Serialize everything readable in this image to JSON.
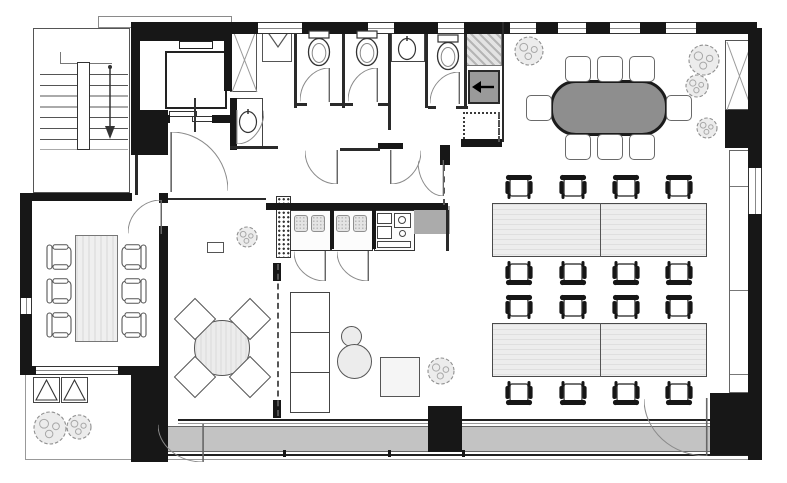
{
  "meta": {
    "drawing_type": "architectural floor plan, black-and-white office fit-out",
    "text_on_image": "none"
  },
  "colors": {
    "wall": "#171717",
    "meeting_table_gray": "#8e8e8e",
    "desk_fill": "#ededed",
    "balcony_gray": "#c3c3c3",
    "service_gray": "#9a9a9a",
    "tree_fill": "#ececec",
    "paper": "#ffffff"
  },
  "inventory": {
    "stairwell": 1,
    "elevator": 1,
    "toilet_stalls": 3,
    "wash_basins": 2,
    "service_shafts_x": 2,
    "dumbwaiter": 1,
    "phone_booths": 2,
    "kitchenette": 1,
    "small_meeting_room_seats": 6,
    "large_meeting_table_seats": 8,
    "desk_banks": 2,
    "desks": 4,
    "task_chairs": 16,
    "lounge_round_table_seats": 4,
    "sofa_sections": 3,
    "poufs": 2,
    "side_tables": 1,
    "trees": 8,
    "planters": 2,
    "balcony_strip": 1,
    "terrace": 1
  },
  "geometry": {
    "walls": [
      [
        131,
        22,
        626,
        12
      ],
      [
        131,
        33,
        101,
        8
      ],
      [
        131,
        33,
        9,
        92
      ],
      [
        224,
        33,
        8,
        58
      ],
      [
        140,
        115,
        30,
        8
      ],
      [
        212,
        115,
        20,
        8
      ],
      [
        131,
        110,
        37,
        45
      ],
      [
        230,
        98,
        7,
        52
      ],
      [
        378,
        143,
        25,
        6
      ],
      [
        440,
        145,
        10,
        20
      ],
      [
        461,
        139,
        41,
        8
      ],
      [
        266,
        203,
        182,
        7
      ],
      [
        330,
        210,
        4,
        39
      ],
      [
        372,
        210,
        4,
        39
      ],
      [
        273,
        263,
        8,
        18
      ],
      [
        273,
        400,
        8,
        18
      ],
      [
        20,
        193,
        112,
        8
      ],
      [
        159,
        193,
        9,
        10
      ],
      [
        20,
        193,
        12,
        180
      ],
      [
        20,
        366,
        148,
        9
      ],
      [
        159,
        226,
        9,
        147
      ],
      [
        131,
        370,
        37,
        92
      ],
      [
        428,
        406,
        34,
        46
      ],
      [
        710,
        393,
        47,
        62
      ],
      [
        748,
        28,
        14,
        432
      ],
      [
        725,
        110,
        28,
        38
      ]
    ],
    "thin_walls": [
      [
        294,
        34,
        3,
        74
      ],
      [
        342,
        34,
        3,
        74
      ],
      [
        388,
        34,
        3,
        96
      ],
      [
        425,
        34,
        3,
        74
      ],
      [
        464,
        34,
        3,
        74
      ],
      [
        297,
        103,
        10,
        3
      ],
      [
        330,
        103,
        15,
        3
      ],
      [
        345,
        103,
        8,
        3
      ],
      [
        378,
        103,
        13,
        3
      ],
      [
        428,
        106,
        8,
        3
      ],
      [
        456,
        106,
        12,
        3
      ],
      [
        230,
        146,
        48,
        3
      ],
      [
        340,
        148,
        40,
        3
      ],
      [
        135,
        155,
        3,
        40
      ],
      [
        168,
        198,
        98,
        2
      ],
      [
        502,
        22,
        2,
        120
      ],
      [
        446,
        210,
        3,
        41
      ]
    ],
    "windows_h": [
      [
        258,
        22,
        44,
        12
      ],
      [
        368,
        22,
        26,
        12
      ],
      [
        438,
        22,
        26,
        12
      ],
      [
        510,
        22,
        26,
        12
      ],
      [
        558,
        22,
        28,
        12
      ],
      [
        610,
        22,
        30,
        12
      ],
      [
        666,
        22,
        30,
        12
      ],
      [
        36,
        366,
        82,
        9
      ]
    ],
    "windows_v": [
      [
        748,
        168,
        14,
        46
      ],
      [
        20,
        298,
        12,
        16
      ]
    ],
    "doors": [
      [
        128,
        200,
        34,
        34,
        "xy"
      ],
      [
        300,
        68,
        30,
        34,
        "xy"
      ],
      [
        348,
        68,
        30,
        34,
        "xy"
      ],
      [
        430,
        72,
        30,
        32,
        "xy"
      ],
      [
        236,
        110,
        28,
        34,
        ""
      ],
      [
        305,
        150,
        33,
        34,
        "x"
      ],
      [
        390,
        150,
        31,
        34,
        ""
      ],
      [
        418,
        160,
        26,
        36,
        "x"
      ],
      [
        170,
        132,
        58,
        60,
        "y"
      ],
      [
        294,
        251,
        32,
        30,
        "x"
      ],
      [
        337,
        251,
        32,
        30,
        "x"
      ],
      [
        158,
        424,
        46,
        38,
        "x"
      ],
      [
        644,
        398,
        64,
        58,
        "x"
      ]
    ],
    "desks": [
      [
        492,
        203,
        215,
        54
      ],
      [
        492,
        323,
        215,
        54
      ]
    ],
    "office_chairs": [
      [
        519,
        189,
        0
      ],
      [
        573,
        189,
        0
      ],
      [
        626,
        189,
        0
      ],
      [
        679,
        189,
        0
      ],
      [
        519,
        271,
        180
      ],
      [
        573,
        271,
        180
      ],
      [
        626,
        271,
        180
      ],
      [
        679,
        271,
        180
      ],
      [
        519,
        309,
        0
      ],
      [
        573,
        309,
        0
      ],
      [
        626,
        309,
        0
      ],
      [
        679,
        309,
        0
      ],
      [
        519,
        391,
        180
      ],
      [
        573,
        391,
        180
      ],
      [
        626,
        391,
        180
      ],
      [
        679,
        391,
        180
      ]
    ],
    "outline_chairs": [
      [
        61,
        257,
        -90
      ],
      [
        61,
        291,
        -90
      ],
      [
        61,
        325,
        -90
      ],
      [
        132,
        257,
        90
      ],
      [
        132,
        291,
        90
      ],
      [
        132,
        325,
        90
      ]
    ],
    "banquet_chairs": [
      [
        565,
        56
      ],
      [
        597,
        56
      ],
      [
        629,
        56
      ],
      [
        565,
        134
      ],
      [
        597,
        134
      ],
      [
        629,
        134
      ],
      [
        526,
        95
      ],
      [
        666,
        95
      ]
    ],
    "diamond_chairs": [
      [
        195,
        319
      ],
      [
        250,
        319
      ],
      [
        195,
        377
      ],
      [
        250,
        377
      ]
    ],
    "toilets": [
      [
        305,
        30
      ],
      [
        353,
        30
      ],
      [
        434,
        34
      ]
    ],
    "sinks": [
      [
        238,
        108
      ],
      [
        397,
        35
      ]
    ],
    "trees": [
      [
        50,
        428,
        17
      ],
      [
        79,
        427,
        13
      ],
      [
        247,
        237,
        11
      ],
      [
        441,
        371,
        14
      ],
      [
        529,
        51,
        15
      ],
      [
        704,
        60,
        16
      ],
      [
        697,
        86,
        12
      ],
      [
        707,
        128,
        11
      ]
    ],
    "planters": [
      [
        33,
        377,
        27,
        26
      ],
      [
        61,
        377,
        27,
        26
      ]
    ],
    "dash_lines": [
      [
        277,
        264,
        152
      ],
      [
        443,
        165,
        40
      ],
      [
        498,
        112,
        30
      ]
    ],
    "window_ticks": [
      [
        283,
        450
      ],
      [
        388,
        450
      ],
      [
        462,
        450
      ]
    ]
  }
}
